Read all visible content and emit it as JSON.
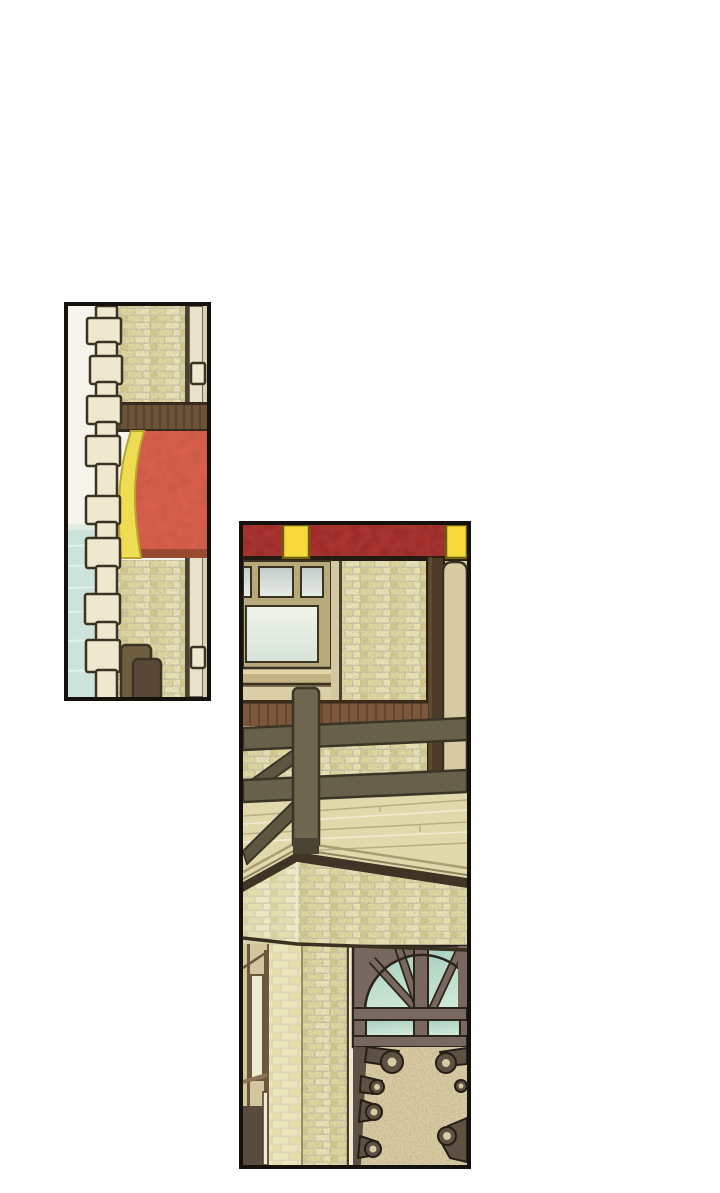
{
  "page": {
    "kind": "webtoon comic page, no text",
    "background": "#ffffff",
    "panel_count": 2
  },
  "scene": {
    "panel_left": "Tall panel: stone block column, cream brick wall, dark wood beam band, red awning with curved yellow trim, pale aqua water at lower left, two wooden posts",
    "panel_right": "Tall panel: red awning band with yellow inserts, casement window with pale glass, brick wall, dark door beam and tan door, wood wainscot, balcony fence rails and post, plank floor, brick parapet corner, arched fan window with teal glass, wrought-iron scrollwork door"
  },
  "colors": {
    "pageBg": "#ffffff",
    "panelBorder": "#15110d",
    "wallWhite": "#f7f4eb",
    "water": "#cbe3da",
    "waterStreak": "#e6f3ed",
    "stone": "#eee8cf",
    "stoneOutline": "#3b3323",
    "mortar": "#cfc7a6",
    "brick": "#e0d8a0",
    "brickLight": "#eae3b8",
    "brickDark": "#d5ca8d",
    "mortarPale": "#ddd6ba",
    "brickPale": "#ede6b8",
    "brickPale2": "#e5deaa",
    "stripLight": "#e9e2ca",
    "stripShade": "#d8d1b6",
    "darkLine": "#4a4130",
    "woodBand": "#6b5238",
    "woodBandLine": "#503b26",
    "woodBandEdge": "#352a1b",
    "awningRed": "#d8604d",
    "awningRust": "#9a4a30",
    "awningYellow": "#eedd52",
    "awningYellowEdge": "#b9a62c",
    "bannerRed": "#a93430",
    "bannerYellow": "#f6d93a",
    "bannerYellowEdge": "#6e5e10",
    "bannerUnderline": "#241b12",
    "frameTan": "#b9aa7c",
    "outlineDark": "#3a3321",
    "sillFace": "#c3b282",
    "sillTop": "#e3d6aa",
    "glassGrayTop": "#c3cdc9",
    "glassGrayBot": "#e7ece6",
    "glassLightTop": "#eff4eb",
    "glassLightBot": "#d6e3d9",
    "glassTealTop": "#a9cfbf",
    "glassTealBot": "#cfe8d8",
    "tanWall": "#d9cea6",
    "tanWall2": "#d4c99e",
    "beam": "#4e3c29",
    "beamHi": "#6a5438",
    "door": "#d8caa2",
    "doorSill": "#3a2d1d",
    "wainscot": "#7b583b",
    "wainscotLine": "#5a3f29",
    "wainscotEdge": "#3a2a1a",
    "floor": "#e1d8ac",
    "floorLineDark": "#b9ae82",
    "floorLineLight": "#f2ecd4",
    "deckEdge": "#a89d74",
    "deckEdge2": "#8f8460",
    "fascia": "#3f3425",
    "railFill": "#67604a",
    "railDiag": "#5d5742",
    "railOutline": "#3a3526",
    "postFill": "#6e664f",
    "postFoot": "#4a4434",
    "postL": "#6f5d41",
    "postD": "#564834",
    "sideWall": "#d3c69c",
    "sideLine": "#6a573c",
    "sidePane": "#f1ead3",
    "sideSill": "#8a7454",
    "doorway": "#594c3f",
    "pillarEdge": "#6b5a3c",
    "pillarEdgeDark": "#4a3c28",
    "cornerLight": "#efe8cc",
    "parapetBottom": "#3a3020",
    "archFrame": "#786860",
    "archFrameDark": "#2b241c",
    "iron": "#5f5044",
    "ironOutline": "#241e16"
  }
}
